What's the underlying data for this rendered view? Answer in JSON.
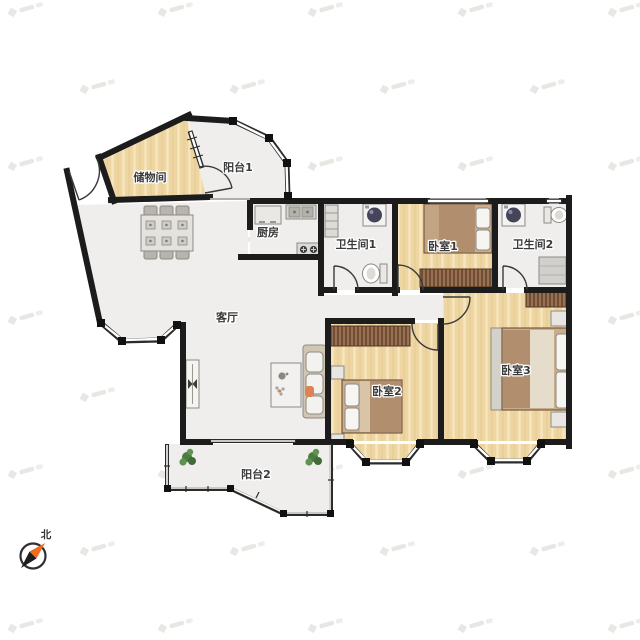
{
  "floorplan": {
    "rooms": {
      "storage": {
        "label": "储物间"
      },
      "balcony1": {
        "label": "阳台1"
      },
      "kitchen": {
        "label": "厨房"
      },
      "bath1": {
        "label": "卫生间1"
      },
      "bedroom1": {
        "label": "卧室1"
      },
      "bath2": {
        "label": "卫生间2"
      },
      "living": {
        "label": "客厅"
      },
      "bedroom2": {
        "label": "卧室2"
      },
      "bedroom3": {
        "label": "卧室3"
      },
      "balcony2": {
        "label": "阳台2"
      }
    },
    "compass": {
      "north_label": "北"
    },
    "colors": {
      "wall": "#1c1c1c",
      "wood": "#eed6a3",
      "tile": "#efeeec",
      "wardrobe": "#9a7253",
      "needle": "#f26a1b",
      "plant": "#4c7a3f"
    }
  }
}
